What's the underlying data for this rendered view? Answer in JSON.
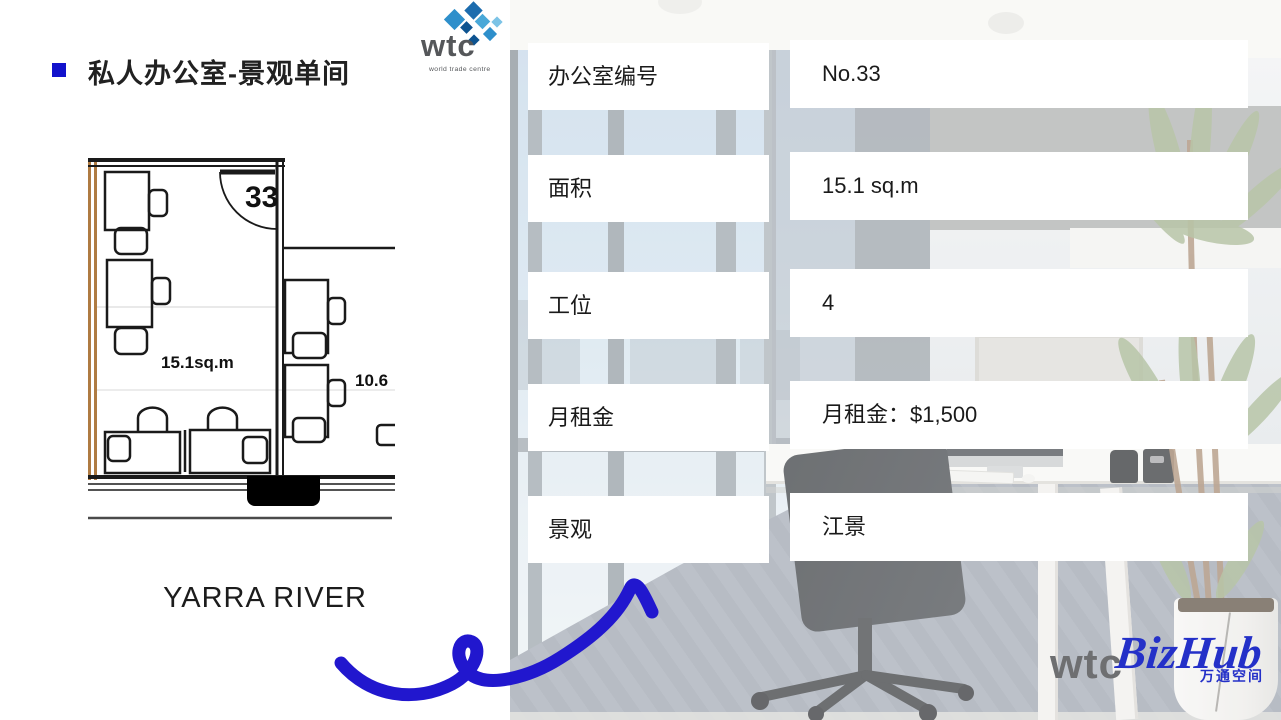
{
  "slide": {
    "title": "私人办公室-景观单间"
  },
  "wtc_logo": {
    "name": "wtc",
    "tagline": "world trade centre"
  },
  "floor_plan": {
    "room_number": "33",
    "room_area": "15.1sq.m",
    "adjacent_area": "10.6",
    "river_label": "YARRA RIVER"
  },
  "details": {
    "rows": [
      {
        "label": "办公室编号",
        "value": "No.33"
      },
      {
        "label": "面积",
        "value": "15.1 sq.m"
      },
      {
        "label": "工位",
        "value": "4"
      },
      {
        "label": "月租金",
        "value": "月租金：$1,500"
      },
      {
        "label": "景观",
        "value": "江景"
      }
    ]
  },
  "footer_logo": {
    "wtc": "wtc",
    "bizhub": "BizHub",
    "subtitle": "万通空间"
  },
  "colors": {
    "bullet_blue": "#1212CC",
    "swirl_blue": "#2117CE",
    "bizhub_blue": "#2430C8",
    "plan_wall_orange": "#B07A45"
  }
}
